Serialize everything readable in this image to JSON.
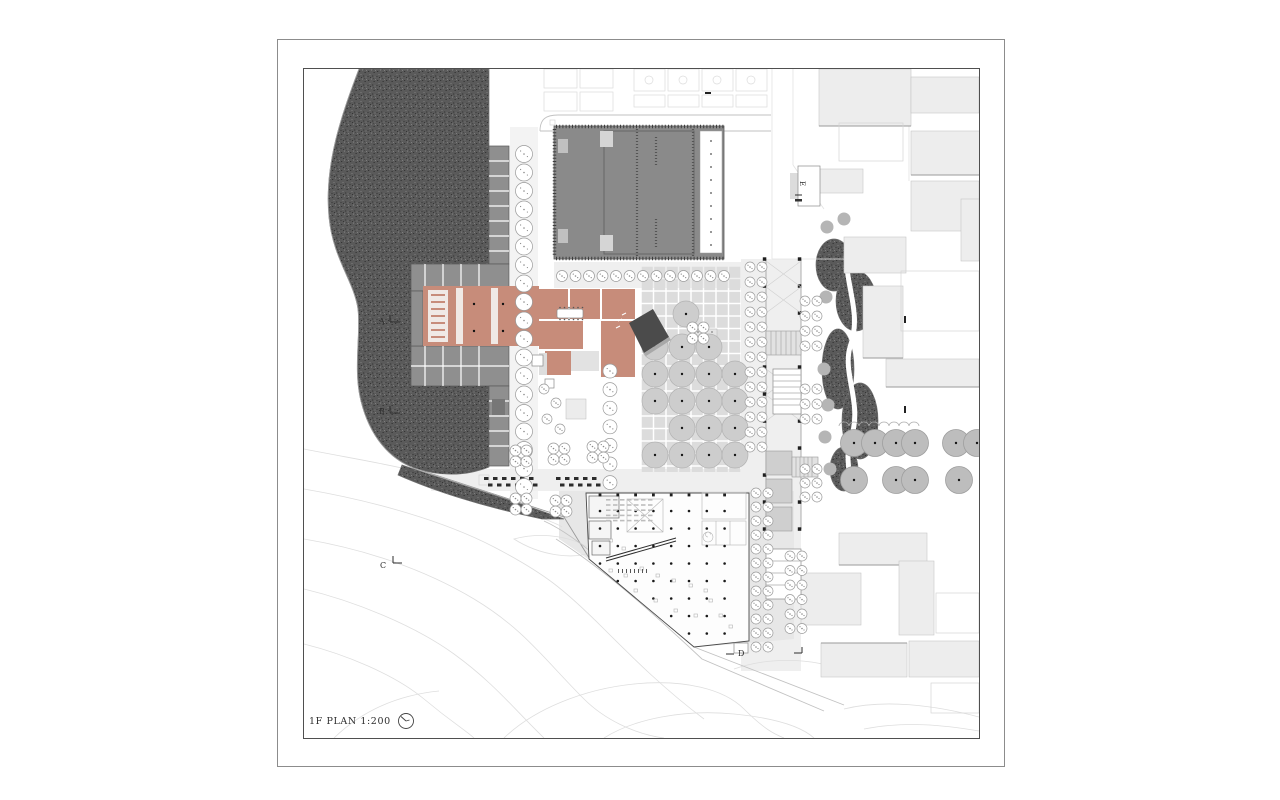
{
  "title_block": {
    "label": "1F PLAN 1:200",
    "north_symbol": "north-clock-icon"
  },
  "section_markers": {
    "a": "A",
    "b": "B",
    "c": "C",
    "d": "D",
    "e": "E"
  },
  "colors": {
    "paper": "#ffffff",
    "frame_outer": "#8c8c8c",
    "frame_inner": "#4f4f4f",
    "vegetation_base": "#5a5a5a",
    "vegetation_dark": "#353535",
    "vegetation_light": "#7d7d7d",
    "auditorium_gray": "#8a8a8a",
    "room_gray": "#8f8f8f",
    "terracotta": "#c78c7a",
    "terracotta_pale": "#f0e9e5",
    "plaza_tile": "#dcdcdc",
    "canopy_gray": "#cdcdcd",
    "big_tree_gray": "#bdbdbd",
    "small_tree_gray": "#b5b5b5",
    "context_fill": "#ededed",
    "context_stroke": "#c6c6c6",
    "ground_light": "#efefef",
    "ground_mid": "#e7e7e7",
    "pavilion_dark": "#4b4b4b",
    "contour_line": "#dedede",
    "road_line": "#c2c2c2",
    "ink": "#2e2e2e"
  }
}
